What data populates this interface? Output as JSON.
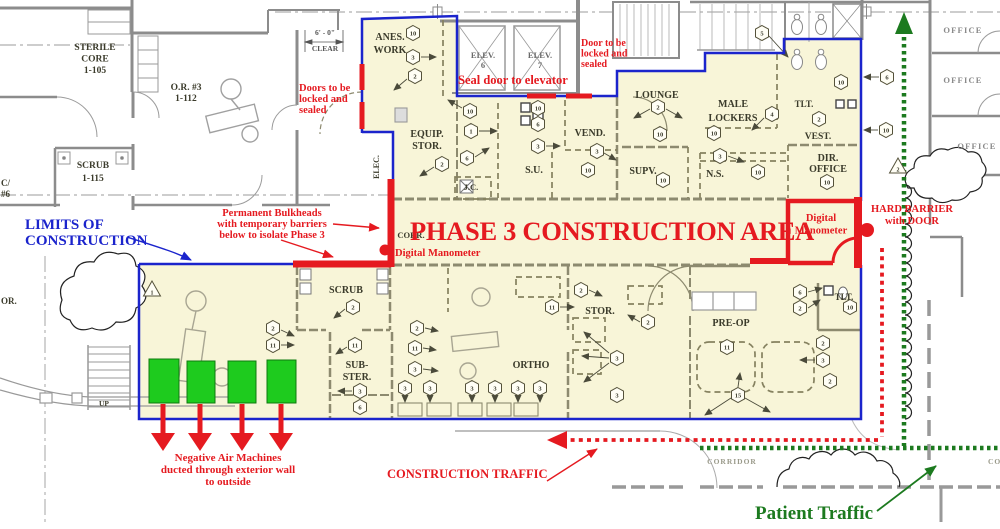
{
  "title": "Phase 3 Construction Area Floor Plan",
  "colors": {
    "construction_fill": "#F8F5D8",
    "annotation_red": "#E51A20",
    "limits_blue": "#1B24CC",
    "machine_green": "#1ECB1E",
    "patient_green": "#1C7A1F",
    "wall_gray": "#8C8C8C",
    "plan_wall_olive": "#8D8A6F",
    "label_ink": "#3B3B2B"
  },
  "plan": {
    "room_labels": [
      {
        "id": "sterile-core",
        "lines": [
          "STERILE",
          "CORE",
          "1-105"
        ],
        "x": 95,
        "y": 50,
        "lh": 11.5,
        "fs": 9.5
      },
      {
        "id": "or-3",
        "lines": [
          "O.R. #3",
          "1-112"
        ],
        "x": 186,
        "y": 90,
        "lh": 11,
        "fs": 9.5
      },
      {
        "id": "scrub-1115",
        "lines": [
          "SCRUB",
          "1-115"
        ],
        "x": 93,
        "y": 168,
        "lh": 13,
        "fs": 9.5
      },
      {
        "id": "c6-partial",
        "lines": [
          "C/",
          "#6"
        ],
        "x": 1,
        "y": 186,
        "lh": 11,
        "fs": 9,
        "anchor": "start"
      },
      {
        "id": "or-partial",
        "lines": [
          "OR."
        ],
        "x": 1,
        "y": 304,
        "fs": 9,
        "anchor": "start"
      },
      {
        "id": "up",
        "lines": [
          "UP"
        ],
        "x": 104,
        "y": 406,
        "fs": 7.5
      },
      {
        "id": "anes-work",
        "lines": [
          "ANES.",
          "WORK"
        ],
        "x": 390,
        "y": 40,
        "lh": 13,
        "fs": 10
      },
      {
        "id": "elev-6",
        "lines": [
          "ELEV.",
          "6"
        ],
        "x": 483,
        "y": 58,
        "lh": 10,
        "fs": 8.5,
        "color": "#6A6A6A"
      },
      {
        "id": "elev-7",
        "lines": [
          "ELEV.",
          "7"
        ],
        "x": 540,
        "y": 58,
        "lh": 10,
        "fs": 8.5,
        "color": "#6A6A6A"
      },
      {
        "id": "equip-stor",
        "lines": [
          "EQUIP.",
          "STOR."
        ],
        "x": 427,
        "y": 137,
        "lh": 12,
        "fs": 10
      },
      {
        "id": "elec",
        "lines": [
          "ELEC."
        ],
        "x": 379,
        "y": 167,
        "fs": 8,
        "rotate": -90
      },
      {
        "id": "jc",
        "lines": [
          "J.C."
        ],
        "x": 471,
        "y": 190,
        "fs": 8.5
      },
      {
        "id": "su",
        "lines": [
          "S.U."
        ],
        "x": 534,
        "y": 173,
        "fs": 10
      },
      {
        "id": "vend",
        "lines": [
          "VEND."
        ],
        "x": 590,
        "y": 136,
        "fs": 10
      },
      {
        "id": "lounge",
        "lines": [
          "LOUNGE"
        ],
        "x": 657,
        "y": 98,
        "fs": 10
      },
      {
        "id": "male-lockers",
        "lines": [
          "MALE",
          "LOCKERS"
        ],
        "x": 733,
        "y": 107,
        "lh": 14,
        "fs": 10
      },
      {
        "id": "supv",
        "lines": [
          "SUPV."
        ],
        "x": 643,
        "y": 174,
        "fs": 10
      },
      {
        "id": "ns",
        "lines": [
          "N.S."
        ],
        "x": 715,
        "y": 177,
        "fs": 10
      },
      {
        "id": "tlt-upper",
        "lines": [
          "TLT."
        ],
        "x": 804,
        "y": 107,
        "fs": 9
      },
      {
        "id": "vest",
        "lines": [
          "VEST."
        ],
        "x": 818,
        "y": 139,
        "fs": 9.5
      },
      {
        "id": "dir-office",
        "lines": [
          "DIR.",
          "OFFICE"
        ],
        "x": 828,
        "y": 161,
        "lh": 11,
        "fs": 10
      },
      {
        "id": "corr",
        "lines": [
          "CORR."
        ],
        "x": 411,
        "y": 238,
        "fs": 8.5
      },
      {
        "id": "scrub-lower",
        "lines": [
          "SCRUB"
        ],
        "x": 346,
        "y": 293,
        "fs": 10
      },
      {
        "id": "sub-ster",
        "lines": [
          "SUB-",
          "STER."
        ],
        "x": 357,
        "y": 368,
        "lh": 12,
        "fs": 10
      },
      {
        "id": "stor-lower",
        "lines": [
          "STOR."
        ],
        "x": 600,
        "y": 314,
        "fs": 10
      },
      {
        "id": "ortho",
        "lines": [
          "ORTHO"
        ],
        "x": 531,
        "y": 368,
        "fs": 10
      },
      {
        "id": "pre-op",
        "lines": [
          "PRE-OP"
        ],
        "x": 731,
        "y": 326,
        "fs": 10
      },
      {
        "id": "tlt-lower",
        "lines": [
          "TLT."
        ],
        "x": 844,
        "y": 300,
        "fs": 9
      },
      {
        "id": "office-1",
        "lines": [
          "OFFICE"
        ],
        "x": 963,
        "y": 33,
        "fs": 8.5,
        "color": "#8A8A8A",
        "ls": 1.2
      },
      {
        "id": "office-2",
        "lines": [
          "OFFICE"
        ],
        "x": 963,
        "y": 83,
        "fs": 8.5,
        "color": "#8A8A8A",
        "ls": 1.2
      },
      {
        "id": "office-3",
        "lines": [
          "OFFICE"
        ],
        "x": 977,
        "y": 149,
        "fs": 8.5,
        "color": "#8A8A8A",
        "ls": 1.2
      },
      {
        "id": "corridor-1",
        "lines": [
          "CORRIDOR"
        ],
        "x": 732,
        "y": 464,
        "fs": 7.5,
        "color": "#9A9A8A",
        "ls": 1
      },
      {
        "id": "corridor-2",
        "lines": [
          "CORRIDOR"
        ],
        "x": 988,
        "y": 464,
        "fs": 7.5,
        "color": "#9A9A8A",
        "ls": 1,
        "anchor": "start"
      },
      {
        "id": "dim-clear",
        "lines": [
          "6' - 0\"",
          "CLEAR"
        ],
        "x": 325,
        "y": 35,
        "lh": 16,
        "fs": 7.5,
        "color": "#555555"
      }
    ],
    "hex_markers": [
      {
        "n": "10",
        "x": 413,
        "y": 33
      },
      {
        "n": "3",
        "x": 413,
        "y": 57
      },
      {
        "n": "2",
        "x": 415,
        "y": 76
      },
      {
        "n": "10",
        "x": 470,
        "y": 111
      },
      {
        "n": "1",
        "x": 471,
        "y": 131
      },
      {
        "n": "6",
        "x": 467,
        "y": 158
      },
      {
        "n": "2",
        "x": 442,
        "y": 164
      },
      {
        "n": "10",
        "x": 538,
        "y": 108
      },
      {
        "n": "6",
        "x": 538,
        "y": 124
      },
      {
        "n": "3",
        "x": 538,
        "y": 146
      },
      {
        "n": "3",
        "x": 597,
        "y": 151
      },
      {
        "n": "10",
        "x": 588,
        "y": 170
      },
      {
        "n": "2",
        "x": 658,
        "y": 107
      },
      {
        "n": "10",
        "x": 660,
        "y": 134
      },
      {
        "n": "10",
        "x": 714,
        "y": 133
      },
      {
        "n": "4",
        "x": 772,
        "y": 114
      },
      {
        "n": "3",
        "x": 720,
        "y": 156
      },
      {
        "n": "5",
        "x": 762,
        "y": 33
      },
      {
        "n": "10",
        "x": 841,
        "y": 82
      },
      {
        "n": "2",
        "x": 819,
        "y": 119
      },
      {
        "n": "10",
        "x": 758,
        "y": 172
      },
      {
        "n": "10",
        "x": 663,
        "y": 180
      },
      {
        "n": "10",
        "x": 827,
        "y": 182
      },
      {
        "n": "6",
        "x": 887,
        "y": 77
      },
      {
        "n": "10",
        "x": 886,
        "y": 130
      },
      {
        "n": "2",
        "x": 417,
        "y": 328
      },
      {
        "n": "11",
        "x": 415,
        "y": 348
      },
      {
        "n": "3",
        "x": 415,
        "y": 369
      },
      {
        "n": "2",
        "x": 273,
        "y": 328
      },
      {
        "n": "11",
        "x": 273,
        "y": 345
      },
      {
        "n": "2",
        "x": 353,
        "y": 307
      },
      {
        "n": "11",
        "x": 355,
        "y": 345
      },
      {
        "n": "3",
        "x": 360,
        "y": 391
      },
      {
        "n": "6",
        "x": 360,
        "y": 407
      },
      {
        "n": "2",
        "x": 581,
        "y": 290
      },
      {
        "n": "11",
        "x": 552,
        "y": 307
      },
      {
        "n": "2",
        "x": 648,
        "y": 322
      },
      {
        "n": "3",
        "x": 617,
        "y": 358
      },
      {
        "n": "3",
        "x": 617,
        "y": 395
      },
      {
        "n": "3",
        "x": 405,
        "y": 388
      },
      {
        "n": "3",
        "x": 430,
        "y": 388
      },
      {
        "n": "3",
        "x": 472,
        "y": 388
      },
      {
        "n": "3",
        "x": 495,
        "y": 388
      },
      {
        "n": "3",
        "x": 518,
        "y": 388
      },
      {
        "n": "3",
        "x": 540,
        "y": 388
      },
      {
        "n": "11",
        "x": 727,
        "y": 347
      },
      {
        "n": "15",
        "x": 738,
        "y": 395
      },
      {
        "n": "6",
        "x": 800,
        "y": 292
      },
      {
        "n": "2",
        "x": 800,
        "y": 308
      },
      {
        "n": "10",
        "x": 850,
        "y": 307
      },
      {
        "n": "2",
        "x": 823,
        "y": 343
      },
      {
        "n": "3",
        "x": 823,
        "y": 360
      },
      {
        "n": "2",
        "x": 830,
        "y": 381
      }
    ],
    "tri_markers": [
      {
        "n": "1",
        "x": 152,
        "y": 290
      },
      {
        "n": "2",
        "x": 898,
        "y": 167
      }
    ]
  },
  "annotations": {
    "notes": [
      {
        "id": "note-doors-locked-left",
        "lines": [
          "Doors to be",
          "locked and",
          "sealed"
        ],
        "x": 299,
        "y": 91,
        "lh": 11,
        "fs": 10.5,
        "anchor": "start",
        "color": "#E51A20"
      },
      {
        "id": "note-seal-door-elevator",
        "lines": [
          "Seal door to elevator"
        ],
        "x": 458,
        "y": 84,
        "fs": 12.5,
        "anchor": "start",
        "color": "#E51A20"
      },
      {
        "id": "note-door-locked-right",
        "lines": [
          "Door to be",
          "locked and",
          "sealed"
        ],
        "x": 581,
        "y": 46,
        "lh": 10.5,
        "fs": 10,
        "anchor": "start",
        "color": "#E51A20"
      },
      {
        "id": "note-permanent-bulkheads",
        "lines": [
          "Permanent Bulkheads",
          "with temporary barriers",
          "below to isolate Phase 3"
        ],
        "x": 272,
        "y": 216,
        "lh": 11,
        "fs": 10.5,
        "anchor": "middle",
        "color": "#E51A20"
      },
      {
        "id": "note-phase3-title",
        "lines": [
          "PHASE 3 CONSTRUCTION AREA"
        ],
        "x": 612,
        "y": 240,
        "fs": 26.5,
        "anchor": "middle",
        "color": "#E51A20",
        "ls": -0.3
      },
      {
        "id": "note-digital-manometer-1",
        "lines": [
          "Digital Manometer"
        ],
        "x": 395,
        "y": 256,
        "fs": 10.5,
        "anchor": "start",
        "color": "#E51A20"
      },
      {
        "id": "note-digital-manometer-2",
        "lines": [
          "Digital",
          "Manometer"
        ],
        "x": 821,
        "y": 221,
        "lh": 12.5,
        "fs": 10.5,
        "anchor": "middle",
        "color": "#E51A20"
      },
      {
        "id": "note-hard-barrier",
        "lines": [
          "HARD BARRIER",
          "with DOOR"
        ],
        "x": 912,
        "y": 212,
        "lh": 12,
        "fs": 10.5,
        "anchor": "middle",
        "color": "#E51A20"
      },
      {
        "id": "note-negative-air",
        "lines": [
          "Negative Air Machines",
          "ducted through exterior wall",
          "to outside"
        ],
        "x": 228,
        "y": 461,
        "lh": 12,
        "fs": 11,
        "anchor": "middle",
        "color": "#E51A20"
      },
      {
        "id": "note-construction-traffic",
        "lines": [
          "CONSTRUCTION TRAFFIC"
        ],
        "x": 387,
        "y": 478,
        "fs": 12.5,
        "anchor": "start",
        "color": "#E51A20"
      },
      {
        "id": "note-limits-of-construction",
        "lines": [
          "LIMITS OF",
          "CONSTRUCTION"
        ],
        "x": 25,
        "y": 229,
        "lh": 16,
        "fs": 15,
        "anchor": "start",
        "color": "#1B24CC"
      },
      {
        "id": "note-patient-traffic",
        "lines": [
          "Patient Traffic"
        ],
        "x": 755,
        "y": 519,
        "fs": 19,
        "anchor": "start",
        "color": "#1C7A1F",
        "weight": "600"
      }
    ]
  }
}
